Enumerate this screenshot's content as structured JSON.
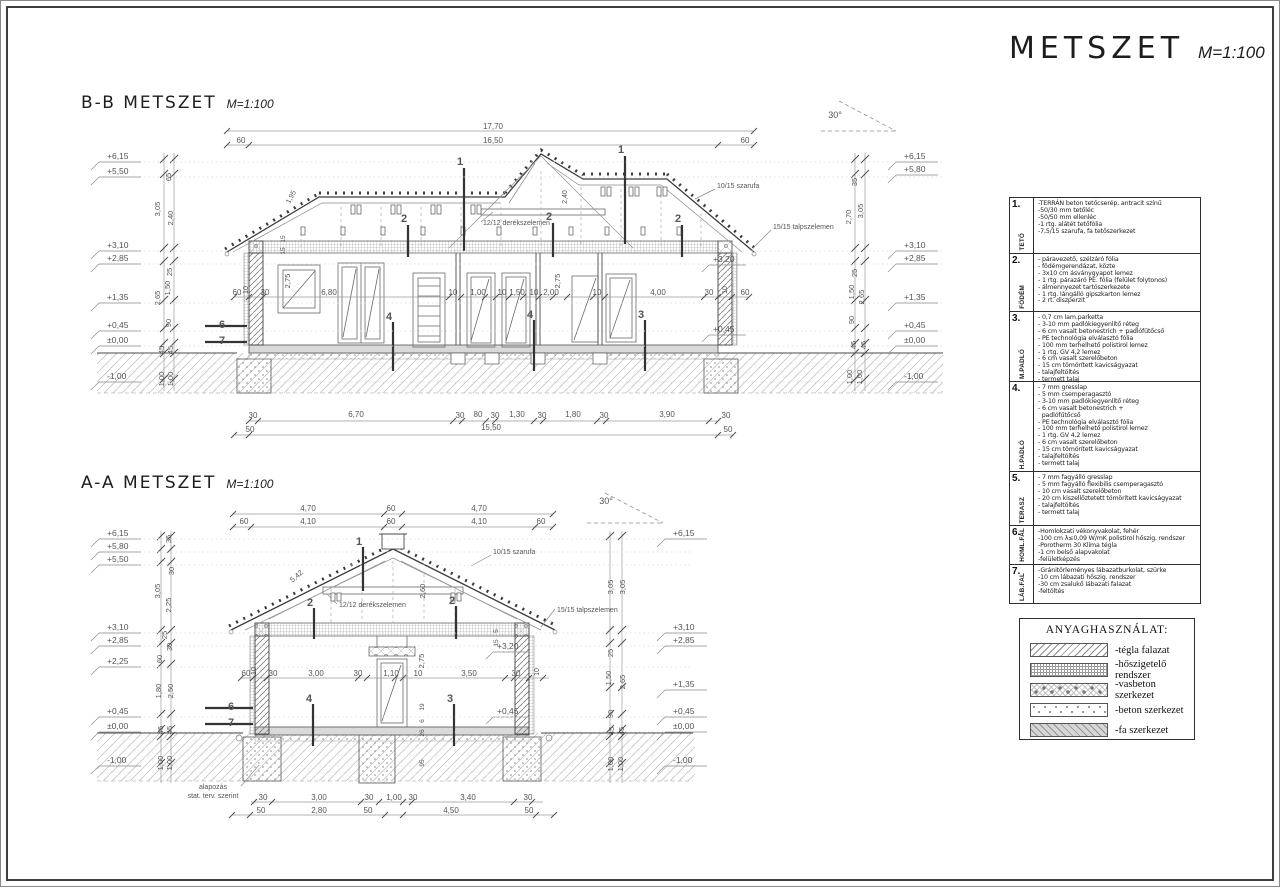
{
  "colors": {
    "paper": "#ffffff",
    "ink": "#3c3c3c",
    "dim_text": "#555555",
    "hatch": "#9a9a9a"
  },
  "page": {
    "title": "METSZET",
    "scale": "M=1:100"
  },
  "sections": {
    "bb": {
      "title": "B-B METSZET",
      "scale": "M=1:100",
      "labels": [
        [
          "17,70",
          492,
          128
        ],
        [
          "16,50",
          492,
          142
        ],
        [
          "60",
          240,
          142
        ],
        [
          "60",
          744,
          142
        ],
        [
          "30°",
          834,
          117,
          0,
          9
        ],
        [
          "10/15 szarufa",
          716,
          187,
          0,
          7,
          0,
          "s"
        ],
        [
          "12/12 derékszelemen",
          482,
          224,
          0,
          7,
          0,
          "s"
        ],
        [
          "15/15 talpszelemen",
          772,
          228,
          0,
          7,
          0,
          "s"
        ],
        [
          "1,95",
          292,
          197,
          -62,
          7
        ],
        [
          "2,40",
          566,
          196,
          -90,
          7
        ],
        [
          "15",
          284,
          238,
          -90,
          6.5
        ],
        [
          "15",
          284,
          250,
          -90,
          6.5
        ],
        [
          "+3,20",
          712,
          261,
          0,
          8.5,
          0,
          "s"
        ],
        [
          "+0,45",
          712,
          331,
          0,
          8.5,
          0,
          "s"
        ],
        [
          "1",
          459,
          164,
          0,
          11,
          1
        ],
        [
          "1",
          620,
          152,
          0,
          11,
          1
        ],
        [
          "2",
          403,
          221,
          0,
          11,
          1
        ],
        [
          "2",
          548,
          219,
          0,
          11,
          1
        ],
        [
          "2",
          677,
          221,
          0,
          11,
          1
        ],
        [
          "4",
          388,
          319,
          0,
          11,
          1
        ],
        [
          "4",
          529,
          317,
          0,
          11,
          1
        ],
        [
          "3",
          640,
          317,
          0,
          11,
          1
        ],
        [
          "6",
          221,
          327,
          0,
          11,
          1
        ],
        [
          "7",
          221,
          343,
          0,
          11,
          1
        ],
        [
          "60",
          236,
          294
        ],
        [
          "10",
          247,
          289,
          -90,
          7
        ],
        [
          "30",
          264,
          294
        ],
        [
          "2,75",
          289,
          280,
          -90,
          7.5
        ],
        [
          "6,80",
          328,
          294
        ],
        [
          "10",
          452,
          294
        ],
        [
          "1,00",
          477,
          294
        ],
        [
          "10",
          501,
          294
        ],
        [
          "1,50",
          516,
          294
        ],
        [
          "10",
          533,
          294
        ],
        [
          "2,00",
          550,
          294
        ],
        [
          "2,75",
          559,
          280,
          -90,
          7.5
        ],
        [
          "10",
          596,
          294
        ],
        [
          "4,00",
          657,
          294
        ],
        [
          "30",
          708,
          294
        ],
        [
          "10",
          726,
          289,
          -90,
          7
        ],
        [
          "60",
          744,
          294
        ],
        [
          "30",
          252,
          417
        ],
        [
          "6,70",
          355,
          416
        ],
        [
          "30",
          459,
          417
        ],
        [
          "80",
          477,
          416
        ],
        [
          "30",
          494,
          417
        ],
        [
          "1,30",
          516,
          416
        ],
        [
          "30",
          541,
          417
        ],
        [
          "1,80",
          572,
          416
        ],
        [
          "30",
          603,
          417
        ],
        [
          "3,90",
          666,
          416
        ],
        [
          "30",
          725,
          417
        ],
        [
          "50",
          249,
          431
        ],
        [
          "15,50",
          490,
          429
        ],
        [
          "50",
          727,
          431
        ],
        [
          "65",
          170,
          176,
          -90,
          7.5
        ],
        [
          "3,05",
          159,
          208,
          -90,
          7.5
        ],
        [
          "2,40",
          172,
          217,
          -90,
          7.5
        ],
        [
          "25",
          171,
          271,
          -90,
          7.5
        ],
        [
          "1,50",
          169,
          287,
          -90,
          7.5
        ],
        [
          "2,65",
          159,
          297,
          -90,
          7.5
        ],
        [
          "90",
          170,
          322,
          -90,
          7.5
        ],
        [
          "45",
          163,
          349,
          -90,
          7.5
        ],
        [
          "45",
          172,
          349,
          -90,
          7.5
        ],
        [
          "1,00",
          163,
          378,
          -90,
          7.5
        ],
        [
          "1,00",
          172,
          378,
          -90,
          7.5
        ],
        [
          "35",
          856,
          181,
          -90,
          7.5
        ],
        [
          "2,70",
          850,
          216,
          -90,
          7.5
        ],
        [
          "3,05",
          862,
          210,
          -90,
          7.5
        ],
        [
          "25",
          856,
          272,
          -90,
          7.5
        ],
        [
          "1,50",
          853,
          291,
          -90,
          7.5
        ],
        [
          "2,65",
          863,
          296,
          -90,
          7.5
        ],
        [
          "90",
          853,
          319,
          -90,
          7.5
        ],
        [
          "45",
          855,
          344,
          -90,
          7.5
        ],
        [
          "45",
          865,
          344,
          -90,
          7.5
        ],
        [
          "1,00",
          851,
          376,
          -90,
          7.5
        ],
        [
          "1,00",
          861,
          376,
          -90,
          7.5
        ]
      ],
      "levels_left": [
        [
          "+6,15",
          158
        ],
        [
          "+5,50",
          173
        ],
        [
          "+3,10",
          247
        ],
        [
          "+2,85",
          260
        ],
        [
          "+1,35",
          299
        ],
        [
          "+0,45",
          327
        ],
        [
          "±0,00",
          342
        ],
        [
          "-1,00",
          378
        ]
      ],
      "levels_right": [
        [
          "+6,15",
          158
        ],
        [
          "+5,80",
          171
        ],
        [
          "+3,10",
          247
        ],
        [
          "+2,85",
          260
        ],
        [
          "+1,35",
          299
        ],
        [
          "+0,45",
          327
        ],
        [
          "±0,00",
          342
        ],
        [
          "-1,00",
          378
        ]
      ]
    },
    "aa": {
      "title": "A-A METSZET",
      "scale": "M=1:100",
      "labels": [
        [
          "4,70",
          307,
          510
        ],
        [
          "60",
          390,
          510
        ],
        [
          "4,70",
          478,
          510
        ],
        [
          "60",
          243,
          523
        ],
        [
          "4,10",
          307,
          523
        ],
        [
          "60",
          390,
          523
        ],
        [
          "4,10",
          478,
          523
        ],
        [
          "60",
          540,
          523
        ],
        [
          "30°",
          605,
          503,
          0,
          9
        ],
        [
          "5,42",
          297,
          577,
          -41,
          7.5
        ],
        [
          "2,60",
          424,
          590,
          -90,
          7.5
        ],
        [
          "10/15 szarufa",
          492,
          553,
          0,
          7,
          0,
          "s"
        ],
        [
          "12/12 derékszelemen",
          338,
          606,
          0,
          7,
          0,
          "s"
        ],
        [
          "15/15 talpszelemen",
          556,
          611,
          0,
          7,
          0,
          "s"
        ],
        [
          "5",
          497,
          630,
          -90,
          6.5
        ],
        [
          "15",
          497,
          642,
          -90,
          6.5
        ],
        [
          "+3,20",
          496,
          648,
          0,
          8.5,
          0,
          "s"
        ],
        [
          "+0,45",
          496,
          713,
          0,
          8.5,
          0,
          "s"
        ],
        [
          "1",
          358,
          544,
          0,
          11,
          1
        ],
        [
          "2",
          309,
          605,
          0,
          11,
          1
        ],
        [
          "2",
          451,
          603,
          0,
          11,
          1
        ],
        [
          "4",
          308,
          701,
          0,
          11,
          1
        ],
        [
          "3",
          449,
          701,
          0,
          11,
          1
        ],
        [
          "6",
          230,
          709,
          0,
          11,
          1
        ],
        [
          "7",
          230,
          725,
          0,
          11,
          1
        ],
        [
          "60",
          245,
          675
        ],
        [
          "10",
          255,
          670,
          -90,
          7
        ],
        [
          "30",
          272,
          675
        ],
        [
          "3,00",
          315,
          675
        ],
        [
          "30",
          357,
          675
        ],
        [
          "1,10",
          390,
          675
        ],
        [
          "10",
          417,
          675
        ],
        [
          "3,50",
          468,
          675
        ],
        [
          "30",
          515,
          675
        ],
        [
          "10",
          538,
          671,
          -90,
          7
        ],
        [
          "2,75",
          423,
          660,
          -90,
          7.5
        ],
        [
          "19",
          423,
          706,
          -90,
          6.5
        ],
        [
          "6",
          423,
          720,
          -90,
          6.5
        ],
        [
          "26",
          423,
          732,
          -90,
          6.5
        ],
        [
          "95",
          423,
          762,
          -90,
          6.5
        ],
        [
          "alapozás",
          212,
          788,
          0,
          7
        ],
        [
          "stat. terv. szerint",
          212,
          797,
          0,
          7
        ],
        [
          "30",
          262,
          799
        ],
        [
          "3,00",
          318,
          799
        ],
        [
          "30",
          368,
          799
        ],
        [
          "1,00",
          393,
          799
        ],
        [
          "30",
          412,
          799
        ],
        [
          "3,40",
          467,
          799
        ],
        [
          "30",
          527,
          799
        ],
        [
          "50",
          260,
          812
        ],
        [
          "2,80",
          318,
          812
        ],
        [
          "50",
          367,
          812
        ],
        [
          "4,50",
          450,
          812
        ],
        [
          "50",
          528,
          812
        ],
        [
          "35",
          170,
          538,
          -90,
          7.5
        ],
        [
          "30",
          173,
          570,
          -90,
          7.5
        ],
        [
          "3,05",
          159,
          590,
          -90,
          7.5
        ],
        [
          "2,25",
          170,
          604,
          -90,
          7.5
        ],
        [
          "25",
          166,
          634,
          -90,
          7.5
        ],
        [
          "30",
          171,
          646,
          -90,
          7.5
        ],
        [
          "60",
          161,
          658,
          -90,
          7.5
        ],
        [
          "1,80",
          160,
          690,
          -90,
          7.5
        ],
        [
          "2,50",
          172,
          690,
          -90,
          7.5
        ],
        [
          "45",
          162,
          729,
          -90,
          7.5
        ],
        [
          "45",
          171,
          729,
          -90,
          7.5
        ],
        [
          "1,00",
          162,
          762,
          -90,
          7.5
        ],
        [
          "1,00",
          171,
          762,
          -90,
          7.5
        ],
        [
          "3,05",
          612,
          586,
          -90,
          7.5
        ],
        [
          "3,05",
          624,
          586,
          -90,
          7.5
        ],
        [
          "25",
          612,
          652,
          -90,
          7.5
        ],
        [
          "1,50",
          610,
          677,
          -90,
          7.5
        ],
        [
          "2,65",
          624,
          681,
          -90,
          7.5
        ],
        [
          "90",
          612,
          713,
          -90,
          7.5
        ],
        [
          "45",
          613,
          730,
          -90,
          7.5
        ],
        [
          "45",
          623,
          730,
          -90,
          7.5
        ],
        [
          "1,00",
          612,
          763,
          -90,
          7.5
        ],
        [
          "1,00",
          622,
          763,
          -90,
          7.5
        ]
      ],
      "levels_left": [
        [
          "+6,15",
          535
        ],
        [
          "+5,80",
          548
        ],
        [
          "+5,50",
          561
        ],
        [
          "+3,10",
          629
        ],
        [
          "+2,85",
          642
        ],
        [
          "+2,25",
          663
        ],
        [
          "+0,45",
          713
        ],
        [
          "±0,00",
          728
        ],
        [
          "-1,00",
          762
        ]
      ],
      "levels_right": [
        [
          "+6,15",
          535
        ],
        [
          "+3,10",
          629
        ],
        [
          "+2,85",
          642
        ],
        [
          "+1,35",
          686
        ],
        [
          "+0,45",
          713
        ],
        [
          "±0,00",
          728
        ],
        [
          "-1,00",
          762
        ]
      ]
    }
  },
  "notes": {
    "rows": [
      {
        "num": "1.",
        "cat": "TETŐ",
        "lines": [
          "-TERRÁN beton tetőcserép, antracit színű",
          "-50/30 mm tetőléc",
          "-50/50 mm ellenléc",
          "-1 rtg. alátét tetőfólia",
          "-7,5/15 szarufa, fa tetőszerkezet"
        ]
      },
      {
        "num": "2.",
        "cat": "FÖDÉM",
        "lines": [
          "- páravezető, szélzáró fólia",
          "- födémgerendázat, közte",
          "- 3x10 cm ásványgyapot lemez",
          "- 1 rtg. párazáró PE. fólia (felület folytonos)",
          "- álmennyezet tartószerkezete",
          "- 1 rtg. lángálló gipszkarton lemez",
          "- 2 rt. diszperzit"
        ]
      },
      {
        "num": "3.",
        "cat": "M.PADLÓ",
        "lines": [
          "- 0,7 cm lam.parketta",
          "- 3-10 mm padlókiegyenlítő réteg",
          "- 6 cm vasalt betonestrich + padlófűtőcső",
          "- PE technológia elválasztó fólia",
          "- 100 mm terhelhető polistirol lemez",
          "- 1 rtg. GV 4,2 lemez",
          "- 6 cm vasalt szerelőbeton",
          "- 15 cm tömörített kavicságyazat",
          "- talajfeltöltés",
          "- termett talaj"
        ]
      },
      {
        "num": "4.",
        "cat": "H.PADLÓ",
        "lines": [
          "- 7 mm gresslap",
          "- 5 mm csemperagasztó",
          "- 3-10 mm padlókiegyenlítő réteg",
          "- 6 cm vasalt betonestrich +",
          "  padlófűtőcső",
          "- PE technológia elválasztó fólia",
          "- 100 mm terhelhető polistirol lemez",
          "- 1 rtg. GV 4,2 lemez",
          "- 6 cm vasalt szerelőbeton",
          "- 15 cm tömörített kavicságyazat",
          "- talajfeltöltés",
          "- termett talaj"
        ]
      },
      {
        "num": "5.",
        "cat": "TERASZ",
        "lines": [
          "- 7 mm fagyálló gresslap",
          "- 5 mm fagyálló flexibilis csemperagasztó",
          "- 10 cm vasalt szerelőbeton",
          "- 20 cm kiszellőztetett tömörített kavicságyazat",
          "- talajfeltöltés",
          "- termett talaj"
        ]
      },
      {
        "num": "6.",
        "cat": "HOML.FAL",
        "lines": [
          "-Homlokzati vékonyvakolat, fehér",
          "-100 cm λ≤0,09 W/mK polistirol hőszig. rendszer",
          "-Porotherm 30 Klíma tégla",
          "-1 cm belső alapvakolat",
          "-felületképzés"
        ]
      },
      {
        "num": "7.",
        "cat": "LÁB.FAL",
        "lines": [
          "-Gránitörleményes lábazatburkolat, szürke",
          "-10 cm lábazati hőszig. rendszer",
          "-30 cm zsalukő lábazati falazat",
          "-feltöltés"
        ]
      }
    ]
  },
  "legend": {
    "title": "ANYAGHASZNÁLAT:",
    "items": [
      {
        "label": "-tégla falazat",
        "pattern": "brick"
      },
      {
        "label": "-hőszigetelő rendszer",
        "pattern": "insulation"
      },
      {
        "label": "-vasbeton szerkezet",
        "pattern": "rc"
      },
      {
        "label": "-beton szerkezet",
        "pattern": "concrete"
      },
      {
        "label": "-fa szerkezet",
        "pattern": "wood"
      }
    ]
  }
}
